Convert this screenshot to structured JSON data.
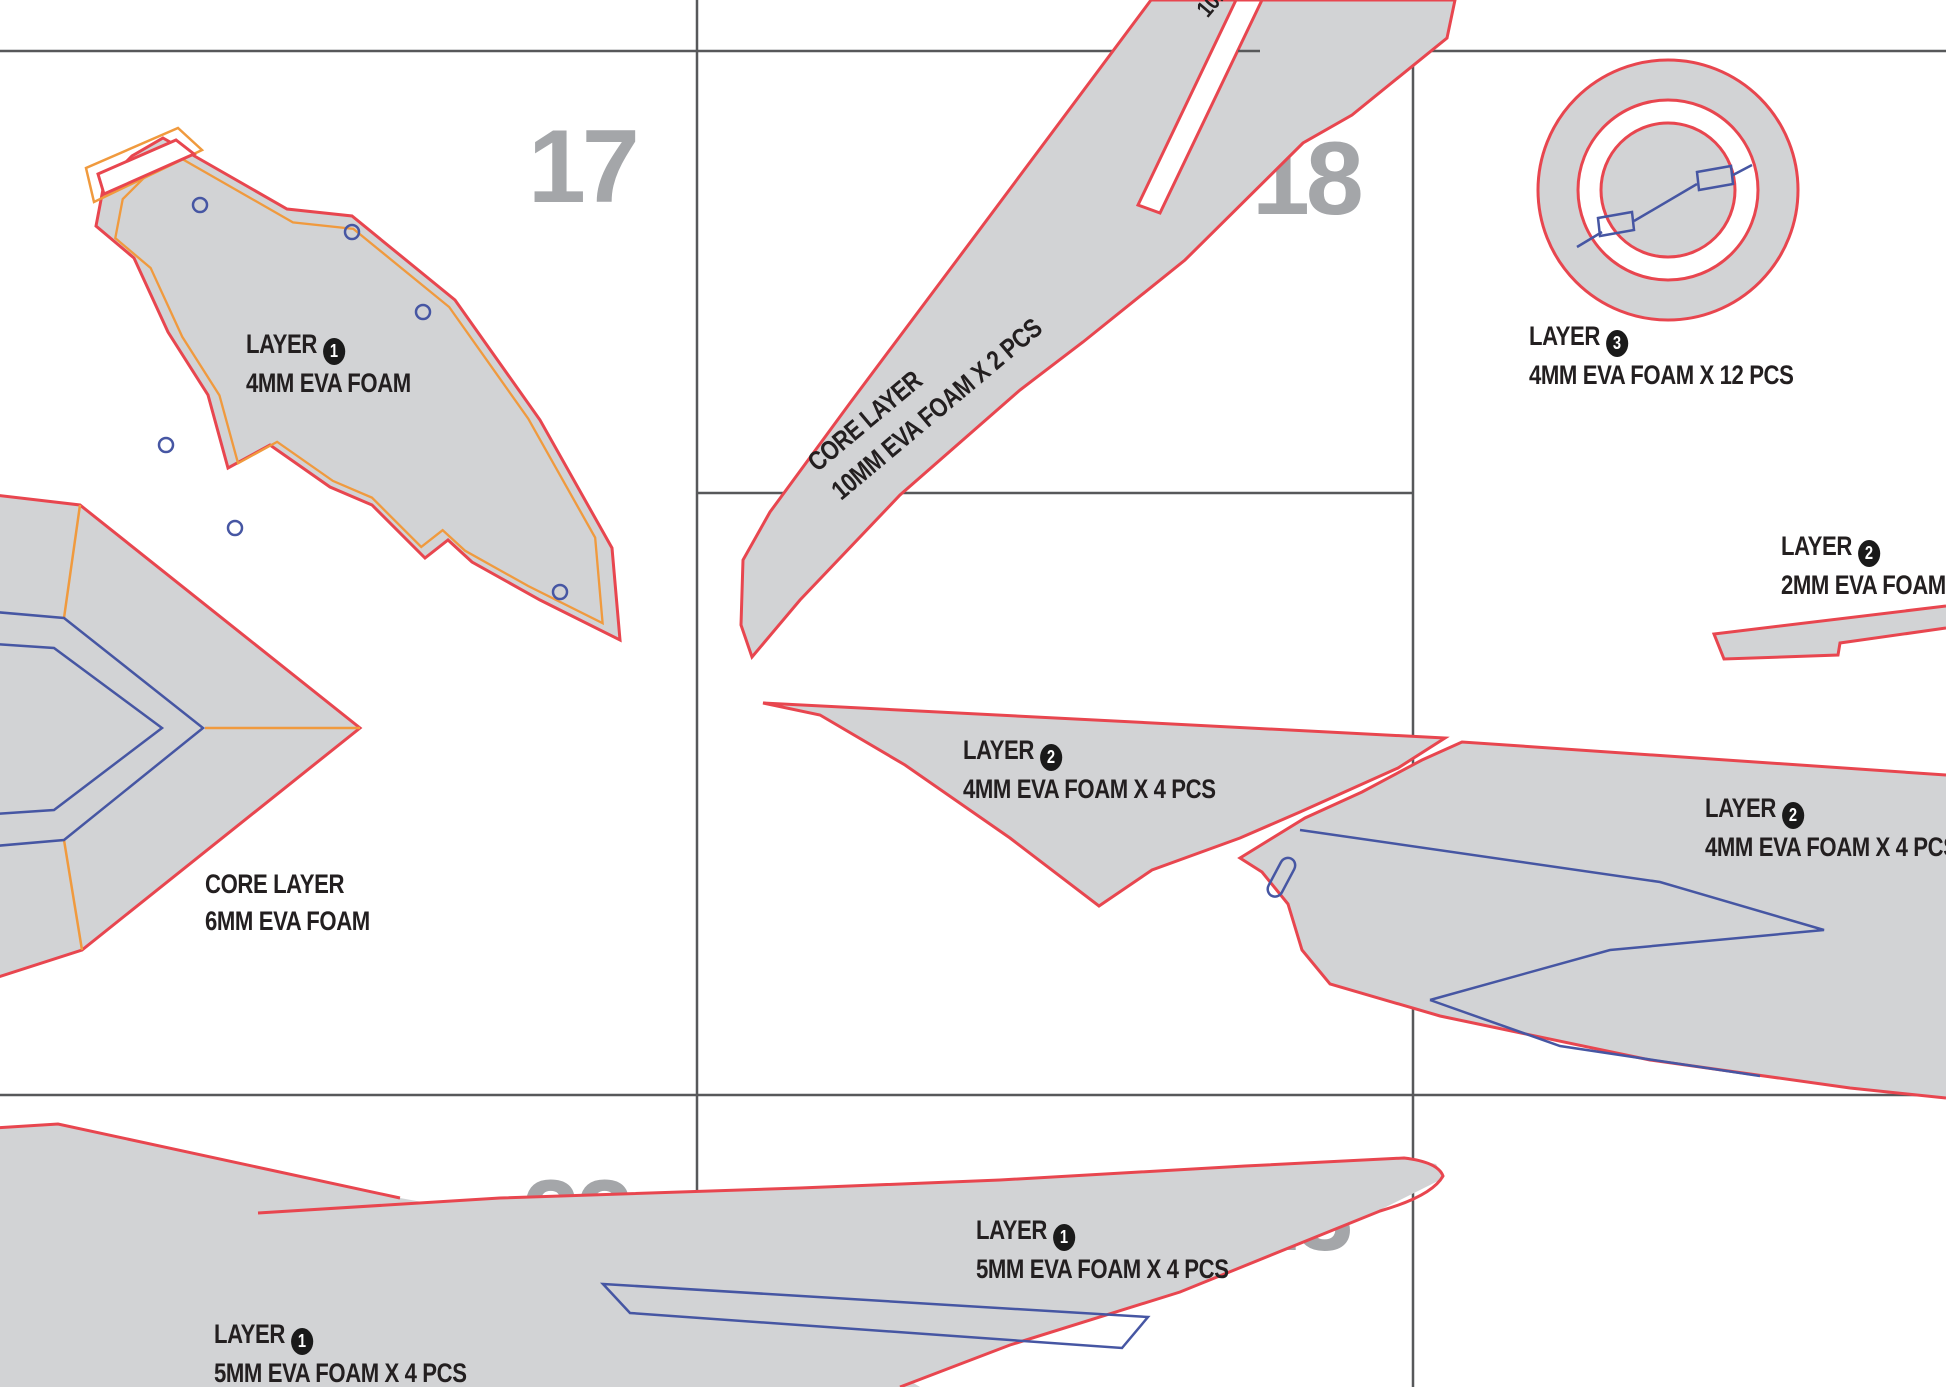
{
  "document": {
    "type": "eva-foam-pattern-sheet",
    "colors": {
      "piece_fill": "#d2d3d5",
      "cut_line_red": "#e8464f",
      "registration_orange": "#f09a3e",
      "detail_blue": "#4656a3",
      "grid_line": "#57585a",
      "page_number_gray": "#a4a6a9",
      "label_text": "#231f20"
    },
    "pages": [
      {
        "number": "17"
      },
      {
        "number": "18"
      },
      {
        "number": "22"
      },
      {
        "number": "23"
      }
    ],
    "labels": {
      "layer1_top": {
        "line1": "LAYER",
        "num": "1",
        "line2": "4MM EVA FOAM"
      },
      "core_blade": {
        "line1": "CORE LAYER",
        "line2": "10MM EVA FOAM X 2 PCS"
      },
      "ring": {
        "line1": "LAYER",
        "num": "3",
        "line2": "4MM EVA FOAM X 12 PCS"
      },
      "strip_2mm": {
        "line1": "LAYER",
        "num": "2",
        "line2": "2MM EVA FOAM X"
      },
      "mid_4mm": {
        "line1": "LAYER",
        "num": "2",
        "line2": "4MM EVA FOAM X 4 PCS"
      },
      "right_4mm": {
        "line1": "LAYER",
        "num": "2",
        "line2": "4MM EVA FOAM X 4 PCS"
      },
      "core_6mm": {
        "line1": "CORE LAYER",
        "line2": "6MM EVA FOAM"
      },
      "bottom_mid": {
        "line1": "LAYER",
        "num": "1",
        "line2": "5MM EVA FOAM X 4 PCS"
      },
      "bottom_left": {
        "line1": "LAYER",
        "num": "1",
        "line2": "5MM EVA FOAM X 4 PCS"
      },
      "top_partial": {
        "line1": "C",
        "line2": "10M"
      }
    }
  }
}
